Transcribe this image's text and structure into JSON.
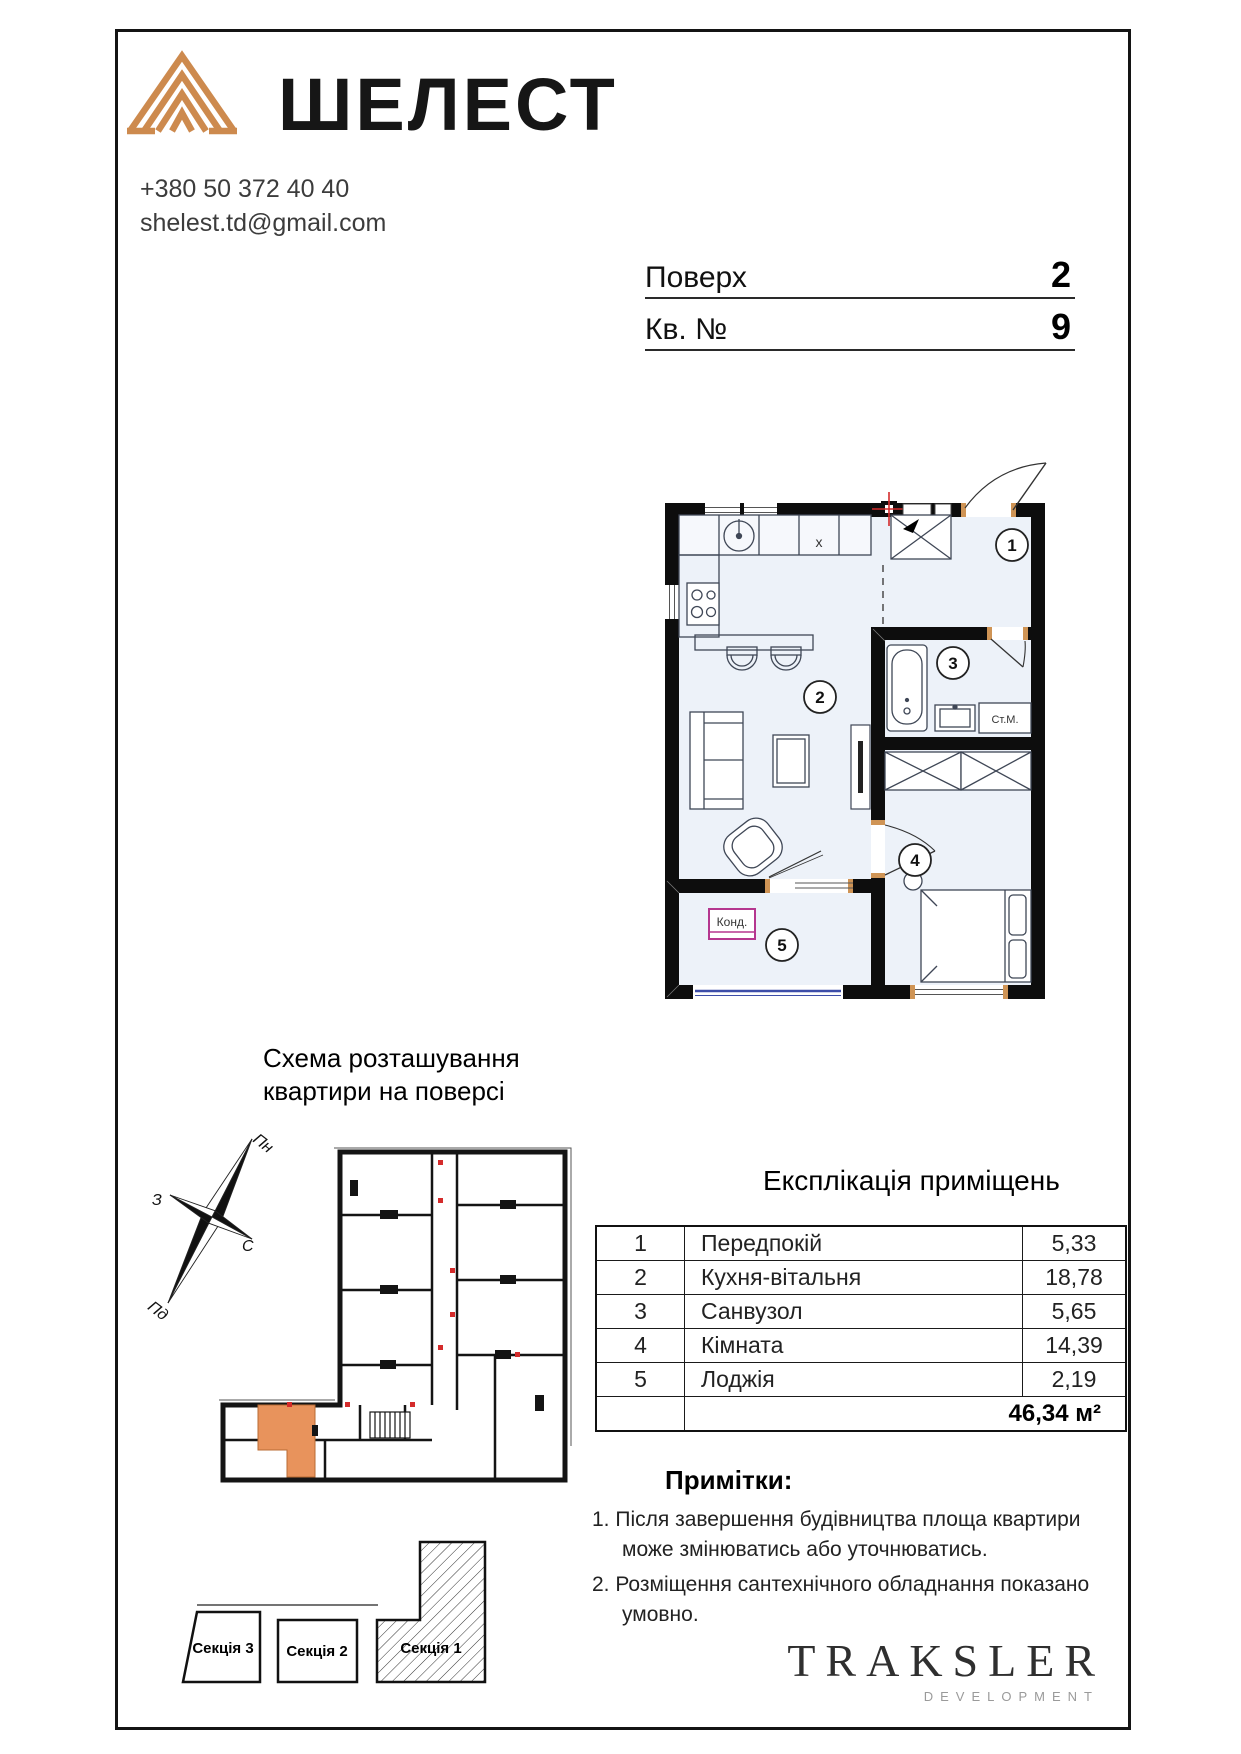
{
  "brand": {
    "name": "ШЕЛЕСТ",
    "phone": "+380 50 372 40 40",
    "email": "shelest.td@gmail.com"
  },
  "header_fields": {
    "floor_label": "Поверх",
    "floor_value": "2",
    "apt_label": "Кв. №",
    "apt_value": "9"
  },
  "plan": {
    "rooms": [
      "1",
      "2",
      "3",
      "4",
      "5"
    ],
    "washer_label": "Ст.М.",
    "ac_label": "Конд.",
    "kitchen_x_label": "x"
  },
  "scheme": {
    "title": "Схема розташування квартири на поверсі",
    "compass": {
      "n": "Пн",
      "w": "З",
      "e": "С",
      "s": "Пд"
    }
  },
  "explication": {
    "title": "Експлікація приміщень",
    "rows": [
      {
        "num": "1",
        "name": "Передпокій",
        "area": "5,33"
      },
      {
        "num": "2",
        "name": "Кухня-вітальня",
        "area": "18,78"
      },
      {
        "num": "3",
        "name": "Санвузол",
        "area": "5,65"
      },
      {
        "num": "4",
        "name": "Кімната",
        "area": "14,39"
      },
      {
        "num": "5",
        "name": "Лоджія",
        "area": "2,19"
      }
    ],
    "total": "46,34 м²"
  },
  "notes": {
    "title": "Примітки:",
    "item1": "1. Після завершення будівництва площа квартири може змінюватись або уточнюватись.",
    "item2": "2. Розміщення сантехнічного обладнання показано умовно."
  },
  "sections": {
    "section3": "Секція 3",
    "section2": "Секція 2",
    "section1": "Секція 1"
  },
  "developer": {
    "name": "TRAKSLER",
    "tagline": "DEVELOPMENT"
  },
  "colors": {
    "brand_accent": "#cd8a4e",
    "apartment_highlight": "#e8935c",
    "ac_box": "#b5368f",
    "loggia_glazing": "#3d4da8",
    "riser_red": "#d42b2b"
  }
}
